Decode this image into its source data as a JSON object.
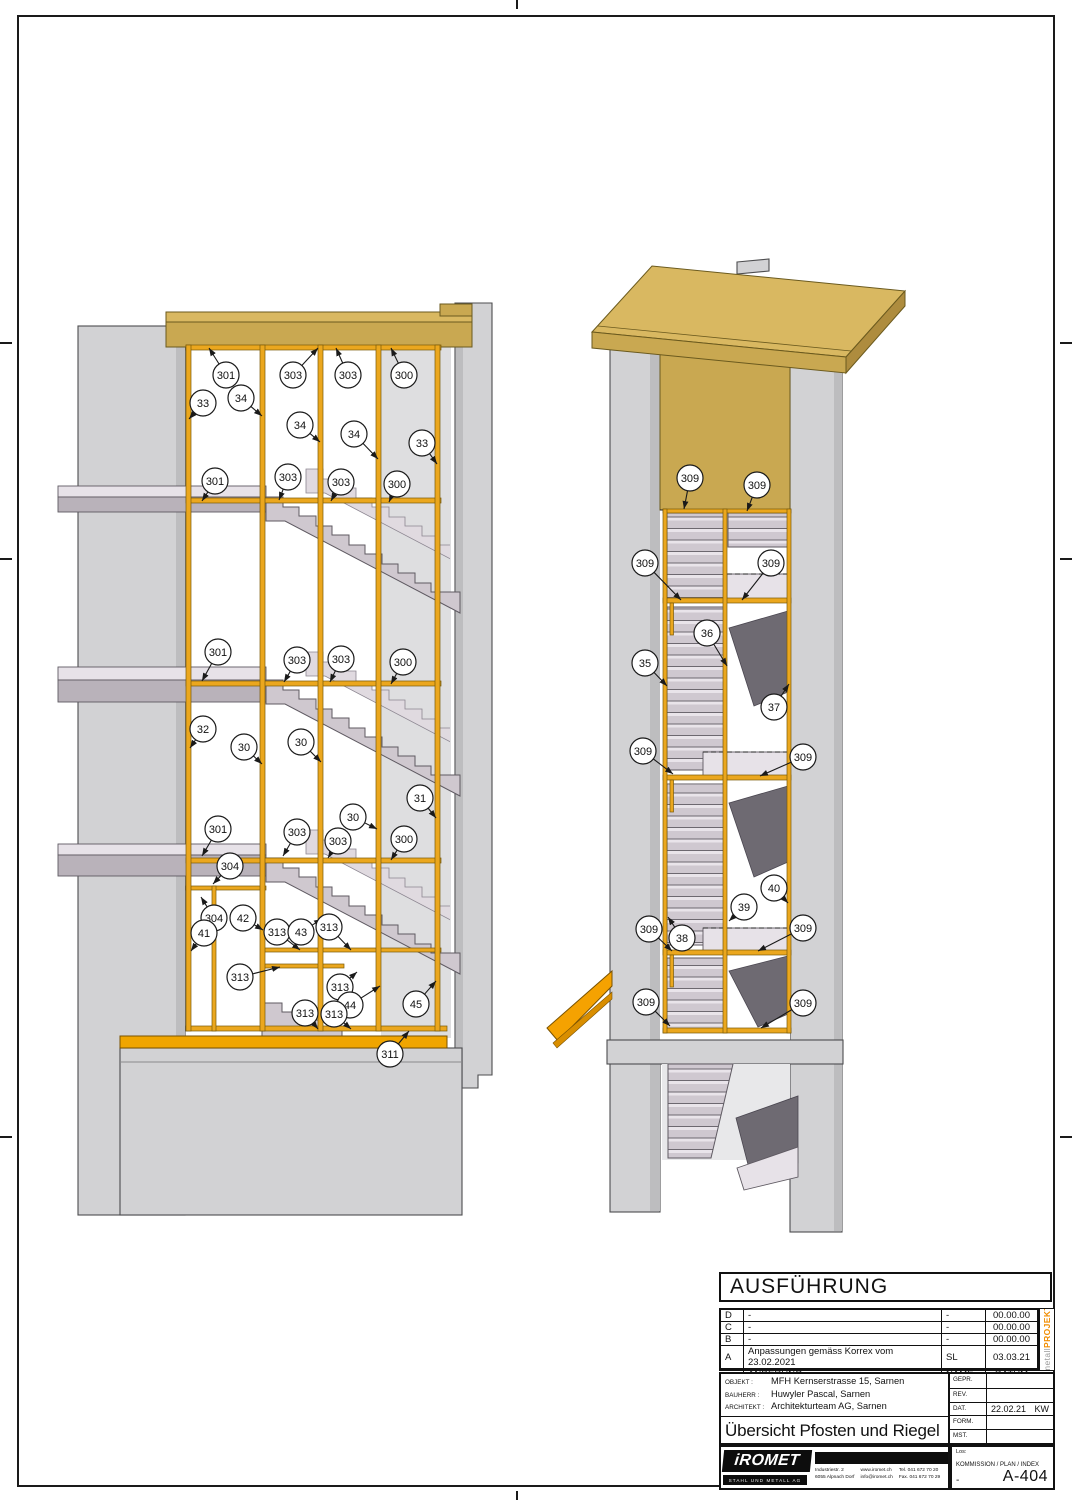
{
  "colors": {
    "roof-top": "#D9B861",
    "roof-front": "#C9A851",
    "roof-side": "#AE8C3E",
    "roof-edge": "#6B5A1E",
    "frame-gold": "#EBA71E",
    "frame-edge": "#7A5A06",
    "wall": "#D2D2D4",
    "wall-dark": "#BDBDBF",
    "stair": "#CFC8CF",
    "stair-light": "#E7E2E8",
    "stair-mid": "#B9B2BA",
    "stair-back": "#E0DAE0",
    "stair-under": "#6E6A72",
    "canopy": "#F5A201",
    "floor-beam": "#F0A500",
    "accent": "#F08C00"
  },
  "drawing": {
    "views": [
      {
        "id": "left-view",
        "callouts": [
          {
            "label": "301",
            "x": 226,
            "y": 375,
            "tx": 209,
            "ty": 348
          },
          {
            "label": "303",
            "x": 293,
            "y": 375,
            "tx": 318,
            "ty": 348
          },
          {
            "label": "303",
            "x": 348,
            "y": 375,
            "tx": 336,
            "ty": 348
          },
          {
            "label": "300",
            "x": 404,
            "y": 375,
            "tx": 391,
            "ty": 348
          },
          {
            "label": "33",
            "x": 203,
            "y": 403,
            "tx": 189,
            "ty": 419
          },
          {
            "label": "34",
            "x": 241,
            "y": 398,
            "tx": 262,
            "ty": 416
          },
          {
            "label": "34",
            "x": 300,
            "y": 425,
            "tx": 320,
            "ty": 442
          },
          {
            "label": "34",
            "x": 354,
            "y": 434,
            "tx": 378,
            "ty": 459
          },
          {
            "label": "33",
            "x": 422,
            "y": 443,
            "tx": 437,
            "ty": 464
          },
          {
            "label": "301",
            "x": 215,
            "y": 481,
            "tx": 202,
            "ty": 501
          },
          {
            "label": "303",
            "x": 288,
            "y": 477,
            "tx": 279,
            "ty": 500
          },
          {
            "label": "303",
            "x": 341,
            "y": 482,
            "tx": 331,
            "ty": 501
          },
          {
            "label": "300",
            "x": 397,
            "y": 484,
            "tx": 389,
            "ty": 502
          },
          {
            "label": "301",
            "x": 218,
            "y": 652,
            "tx": 202,
            "ty": 681
          },
          {
            "label": "303",
            "x": 297,
            "y": 660,
            "tx": 284,
            "ty": 682
          },
          {
            "label": "303",
            "x": 341,
            "y": 659,
            "tx": 330,
            "ty": 682
          },
          {
            "label": "300",
            "x": 403,
            "y": 662,
            "tx": 391,
            "ty": 684
          },
          {
            "label": "32",
            "x": 203,
            "y": 729,
            "tx": 190,
            "ty": 748
          },
          {
            "label": "30",
            "x": 244,
            "y": 747,
            "tx": 262,
            "ty": 764
          },
          {
            "label": "30",
            "x": 301,
            "y": 742,
            "tx": 321,
            "ty": 762
          },
          {
            "label": "30",
            "x": 353,
            "y": 817,
            "tx": 377,
            "ty": 829
          },
          {
            "label": "31",
            "x": 420,
            "y": 798,
            "tx": 436,
            "ty": 818
          },
          {
            "label": "301",
            "x": 218,
            "y": 829,
            "tx": 202,
            "ty": 856
          },
          {
            "label": "303",
            "x": 297,
            "y": 832,
            "tx": 283,
            "ty": 856
          },
          {
            "label": "303",
            "x": 338,
            "y": 841,
            "tx": 328,
            "ty": 858
          },
          {
            "label": "300",
            "x": 404,
            "y": 839,
            "tx": 391,
            "ty": 860
          },
          {
            "label": "304",
            "x": 230,
            "y": 866,
            "tx": 213,
            "ty": 884
          },
          {
            "label": "304",
            "x": 214,
            "y": 918,
            "tx": 201,
            "ty": 897
          },
          {
            "label": "42",
            "x": 243,
            "y": 918,
            "tx": 263,
            "ty": 930
          },
          {
            "label": "41",
            "x": 204,
            "y": 933,
            "tx": 191,
            "ty": 951
          },
          {
            "label": "313",
            "x": 277,
            "y": 932,
            "tx": 300,
            "ty": 950
          },
          {
            "label": "43",
            "x": 301,
            "y": 932,
            "tx": 322,
            "ty": 919
          },
          {
            "label": "313",
            "x": 329,
            "y": 927,
            "tx": 351,
            "ty": 950
          },
          {
            "label": "313",
            "x": 240,
            "y": 977,
            "tx": 280,
            "ty": 967
          },
          {
            "label": "313",
            "x": 340,
            "y": 987,
            "tx": 357,
            "ty": 972
          },
          {
            "label": "44",
            "x": 350,
            "y": 1005,
            "tx": 380,
            "ty": 986
          },
          {
            "label": "45",
            "x": 416,
            "y": 1004,
            "tx": 436,
            "ty": 981
          },
          {
            "label": "313",
            "x": 305,
            "y": 1013,
            "tx": 318,
            "ty": 1029
          },
          {
            "label": "313",
            "x": 334,
            "y": 1014,
            "tx": 351,
            "ty": 1029
          },
          {
            "label": "311",
            "x": 390,
            "y": 1054,
            "tx": 409,
            "ty": 1031
          }
        ]
      },
      {
        "id": "right-view",
        "callouts": [
          {
            "label": "309",
            "x": 690,
            "y": 478,
            "tx": 684,
            "ty": 509
          },
          {
            "label": "309",
            "x": 757,
            "y": 485,
            "tx": 747,
            "ty": 511
          },
          {
            "label": "309",
            "x": 645,
            "y": 563,
            "tx": 681,
            "ty": 600
          },
          {
            "label": "309",
            "x": 771,
            "y": 563,
            "tx": 742,
            "ty": 600
          },
          {
            "label": "36",
            "x": 707,
            "y": 633,
            "tx": 727,
            "ty": 666
          },
          {
            "label": "35",
            "x": 645,
            "y": 663,
            "tx": 667,
            "ty": 686
          },
          {
            "label": "37",
            "x": 774,
            "y": 707,
            "tx": 789,
            "ty": 684
          },
          {
            "label": "309",
            "x": 643,
            "y": 751,
            "tx": 673,
            "ty": 774
          },
          {
            "label": "309",
            "x": 803,
            "y": 757,
            "tx": 760,
            "ty": 776
          },
          {
            "label": "40",
            "x": 774,
            "y": 888,
            "tx": 788,
            "ty": 903
          },
          {
            "label": "39",
            "x": 744,
            "y": 907,
            "tx": 729,
            "ty": 921
          },
          {
            "label": "38",
            "x": 682,
            "y": 938,
            "tx": 668,
            "ty": 917
          },
          {
            "label": "309",
            "x": 649,
            "y": 929,
            "tx": 672,
            "ty": 951
          },
          {
            "label": "309",
            "x": 803,
            "y": 928,
            "tx": 758,
            "ty": 951
          },
          {
            "label": "309",
            "x": 646,
            "y": 1002,
            "tx": 670,
            "ty": 1026
          },
          {
            "label": "309",
            "x": 803,
            "y": 1003,
            "tx": 761,
            "ty": 1028
          }
        ]
      }
    ]
  },
  "titleblock": {
    "status": "AUSFÜHRUNG",
    "revisions": {
      "rows": [
        {
          "index": "D",
          "desc": "-",
          "name": "-",
          "date": "00.00.00"
        },
        {
          "index": "C",
          "desc": "-",
          "name": "-",
          "date": "00.00.00"
        },
        {
          "index": "B",
          "desc": "-",
          "name": "-",
          "date": "00.00.00"
        },
        {
          "index": "A",
          "desc": "Anpassungen gemäss Korrex vom 23.02.2021",
          "name": "SL",
          "date": "03.03.21"
        }
      ],
      "header": {
        "change": "ÄNDERUNG",
        "name": "NAME",
        "date": "DATUM"
      }
    },
    "side": {
      "gray": "metall",
      "orange": "PROJEKT"
    },
    "project": {
      "objekt_label": "OBJEKT :",
      "objekt": "MFH Kernserstrasse 15, Sarnen",
      "bauherr_label": "BAUHERR :",
      "bauherr": "Huwyler Pascal, Sarnen",
      "architekt_label": "ARCHITEKT :",
      "architekt": "Architekturteam AG, Sarnen",
      "title": "Übersicht Pfosten und Riegel",
      "subtitle": "Ansicht"
    },
    "meta": {
      "gepr_label": "GEPR.",
      "gepr": "",
      "rev_label": "REV.",
      "rev": "",
      "dat_label": "DAT.",
      "dat": "22.02.21",
      "dat_kw": "KW",
      "form_label": "FORM.",
      "form": "",
      "mst_label": "MST.",
      "mst": "",
      "los_label": "Los:",
      "kommission_label": "KOMMISSION / PLAN / INDEX",
      "kommission_value": "-",
      "plan_number": "A-404"
    },
    "logo": {
      "name": "iROMET",
      "tagline": "STAHL UND METALL AG",
      "address_line1": "Industriestr. 2",
      "address_line2": "6055 Alpnach Dorf",
      "web": "www.iromet.ch",
      "email": "info@iromet.ch",
      "tel": "Tel. 041 672 70 20",
      "fax": "Fax. 041 672 70 29"
    }
  }
}
